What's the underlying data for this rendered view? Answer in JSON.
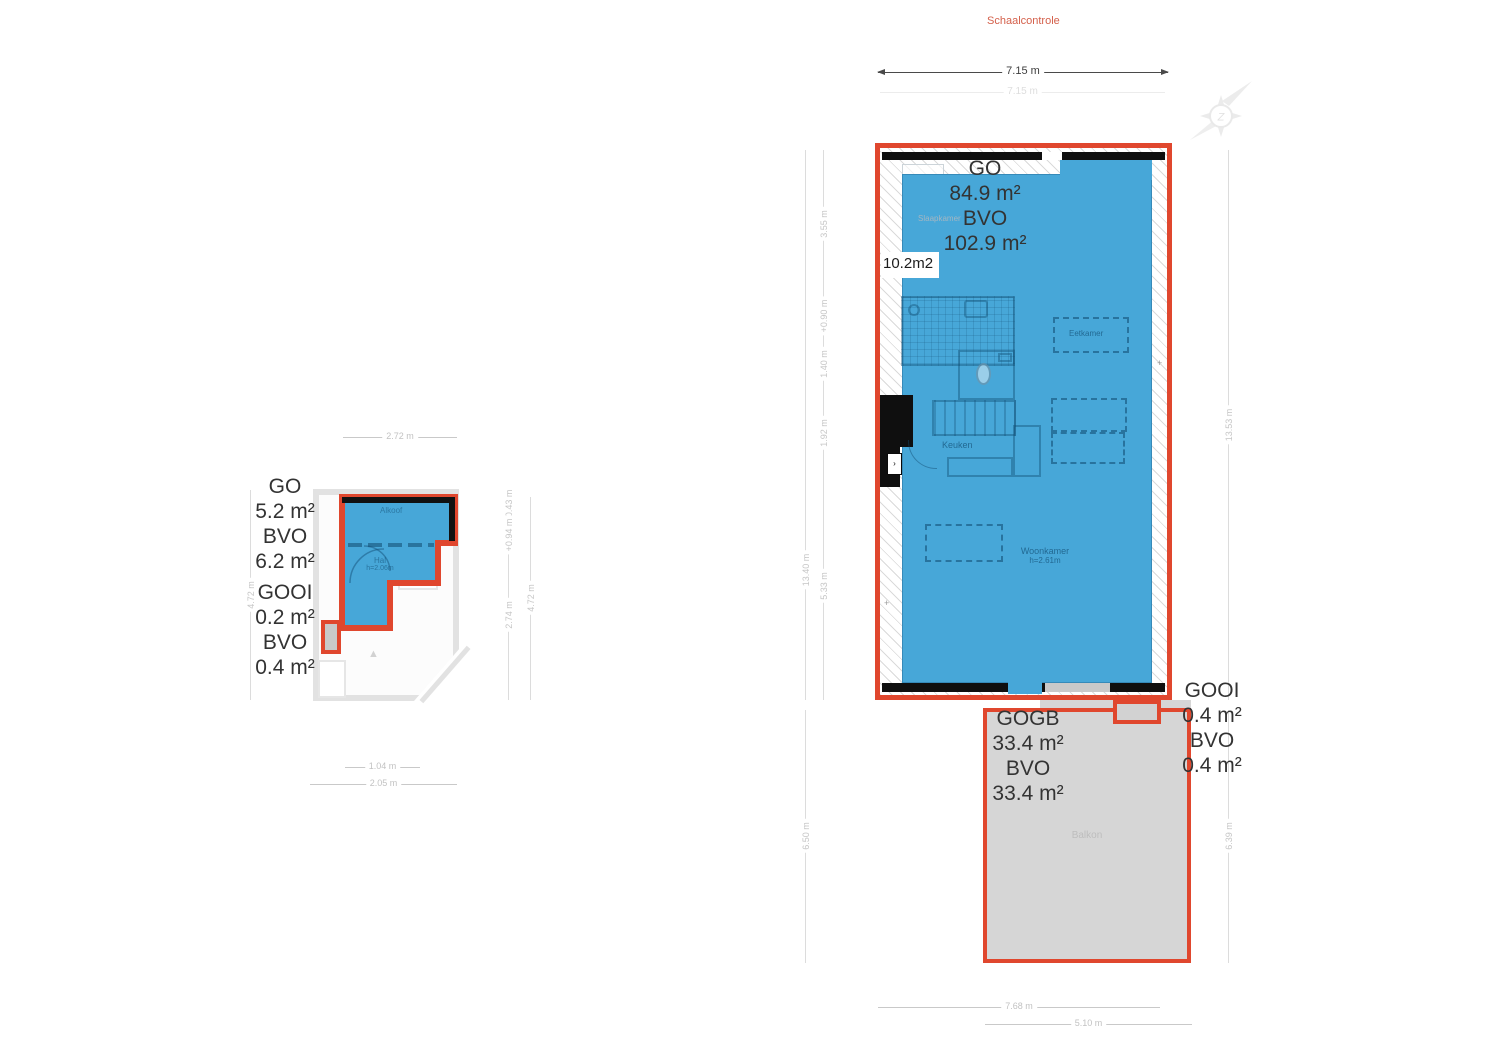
{
  "colors": {
    "accent_red": "#e0472e",
    "fill_blue": "#47a7d8",
    "balcony_gray": "#d6d6d6",
    "wall_black": "#0f0f0f"
  },
  "header": {
    "schaalcontrole": "Schaalcontrole"
  },
  "compass": {
    "letter": "Z"
  },
  "top_dim": {
    "primary": "7.15 m",
    "shadow": "7.15 m"
  },
  "large_plan": {
    "area_block": {
      "go_label": "GO",
      "go_value": "84.9 m²",
      "bvo_label": "BVO",
      "bvo_value": "102.9 m²"
    },
    "side_area": "10.2m2",
    "plus_mark": "+",
    "rooms": {
      "slaapkamer": "Slaapkamer",
      "keuken": "Keuken",
      "eetkamer": "Eetkamer",
      "woonkamer": "Woonkamer",
      "woonkamer_h": "h=2.61m"
    },
    "dims": {
      "left_total": "13.40 m",
      "seg_1": "3.55 m",
      "seg_2": "+0.90 m",
      "seg_3": "1.40 m",
      "seg_4": "1.92 m",
      "seg_5": "5.33 m",
      "left_lower": "6.50 m",
      "right_total": "13.53 m",
      "right_lower": "6.39 m",
      "bottom_outer": "7.68 m",
      "bottom_inner": "5.10 m"
    }
  },
  "balcony": {
    "name": "Balkon",
    "gogb_label": "GOGB",
    "gogb_value": "33.4 m²",
    "bvo_label": "BVO",
    "bvo_value": "33.4 m²"
  },
  "gooi_right": {
    "label": "GOOI",
    "value": "0.4 m²",
    "bvo_label": "BVO",
    "bvo_value": "0.4 m²"
  },
  "small_plan": {
    "area_block": {
      "go_label": "GO",
      "go_value": "5.2 m²",
      "bvo_label": "BVO",
      "bvo_value": "6.2 m²"
    },
    "gooi_block": {
      "label": "GOOI",
      "value": "0.2 m²",
      "bvo_label": "BVO",
      "bvo_value": "0.4 m²"
    },
    "rooms": {
      "top_room": "Alkoof",
      "hal": "Hal",
      "hal_h": "h=2.06m"
    },
    "dims": {
      "top": "2.72 m",
      "left_total": "4.72 m",
      "right_total": "4.72 m",
      "rseg_1": "+0.43 m",
      "rseg_2": "+0.94 m",
      "rseg_3": "2.74 m",
      "bottom_inner": "1.04 m",
      "bottom_outer": "2.05 m"
    }
  }
}
